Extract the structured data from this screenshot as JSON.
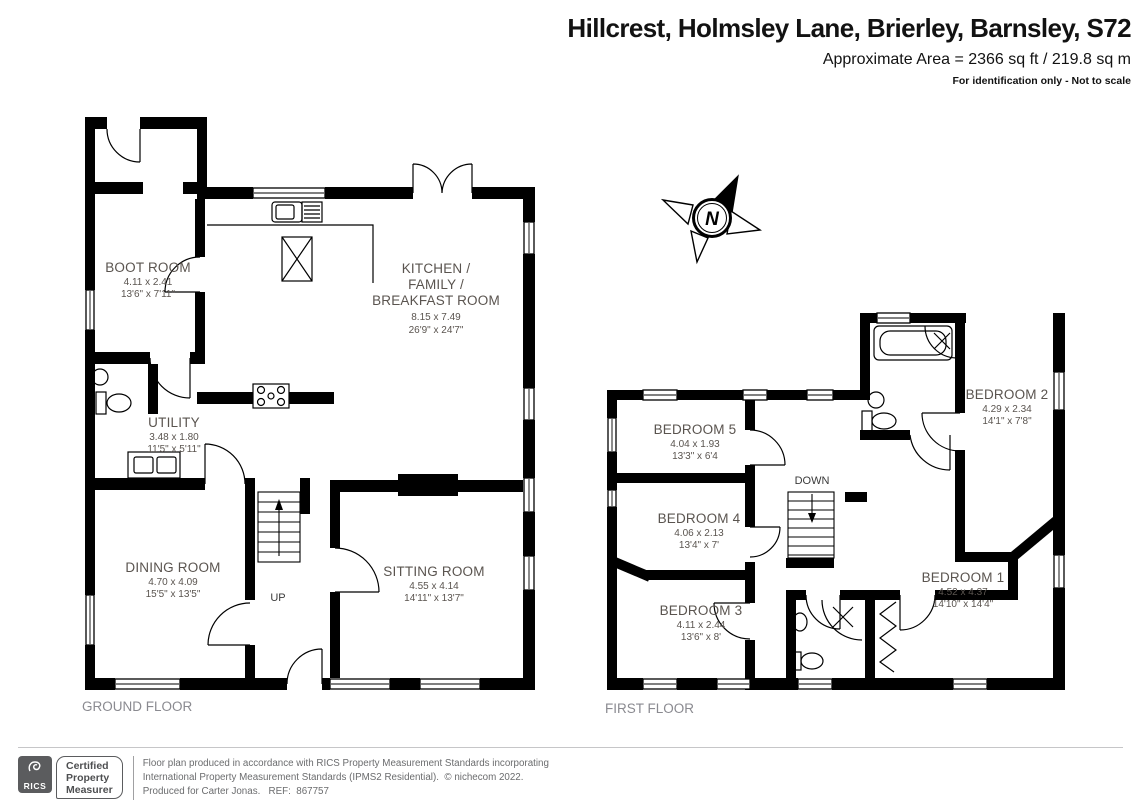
{
  "header": {
    "title": "Hillcrest, Holmsley Lane, Brierley, Barnsley, S72",
    "area": "Approximate Area = 2366 sq ft / 219.8 sq m",
    "note": "For identification only - Not to scale"
  },
  "compass": {
    "label": "N"
  },
  "ground_floor": {
    "label": "GROUND FLOOR",
    "stairs_label": "UP",
    "rooms": {
      "boot_room": {
        "name": "BOOT ROOM",
        "metric": "4.11 x 2.41",
        "imperial": "13'6\" x 7'11\""
      },
      "kitchen": {
        "name_line1": "KITCHEN /",
        "name_line2": "FAMILY /",
        "name_line3": "BREAKFAST ROOM",
        "metric": "8.15 x 7.49",
        "imperial": "26'9\" x 24'7\""
      },
      "utility": {
        "name": "UTILITY",
        "metric": "3.48 x 1.80",
        "imperial": "11'5\" x 5'11\""
      },
      "dining_room": {
        "name": "DINING ROOM",
        "metric": "4.70 x 4.09",
        "imperial": "15'5\" x 13'5\""
      },
      "sitting_room": {
        "name": "SITTING ROOM",
        "metric": "4.55 x 4.14",
        "imperial": "14'11\" x 13'7\""
      }
    }
  },
  "first_floor": {
    "label": "FIRST FLOOR",
    "stairs_label": "DOWN",
    "rooms": {
      "bedroom_5": {
        "name": "BEDROOM 5",
        "metric": "4.04 x 1.93",
        "imperial": "13'3\" x 6'4"
      },
      "bedroom_2": {
        "name": "BEDROOM 2",
        "metric": "4.29 x 2.34",
        "imperial": "14'1\" x 7'8\""
      },
      "bedroom_4": {
        "name": "BEDROOM 4",
        "metric": "4.06 x 2.13",
        "imperial": "13'4\" x 7'"
      },
      "bedroom_1": {
        "name": "BEDROOM 1",
        "metric": "4.52 x 4.37",
        "imperial": "14'10\" x 14'4\""
      },
      "bedroom_3": {
        "name": "BEDROOM 3",
        "metric": "4.11 x 2.44",
        "imperial": "13'6\" x 8'"
      }
    }
  },
  "footer": {
    "logo": {
      "text": "RICS"
    },
    "badge": {
      "line1": "Certified",
      "line2": "Property",
      "line3": "Measurer"
    },
    "lines": {
      "l1": "Floor plan produced in accordance with RICS Property Measurement Standards incorporating",
      "l2": "International Property Measurement Standards (IPMS2 Residential).  © nichecom 2022.",
      "l3": "Produced for Carter Jonas.   REF:  867757"
    }
  },
  "colors": {
    "wall": "#000000",
    "room_text": "#5a544f",
    "floor_label": "#8a8a90"
  }
}
